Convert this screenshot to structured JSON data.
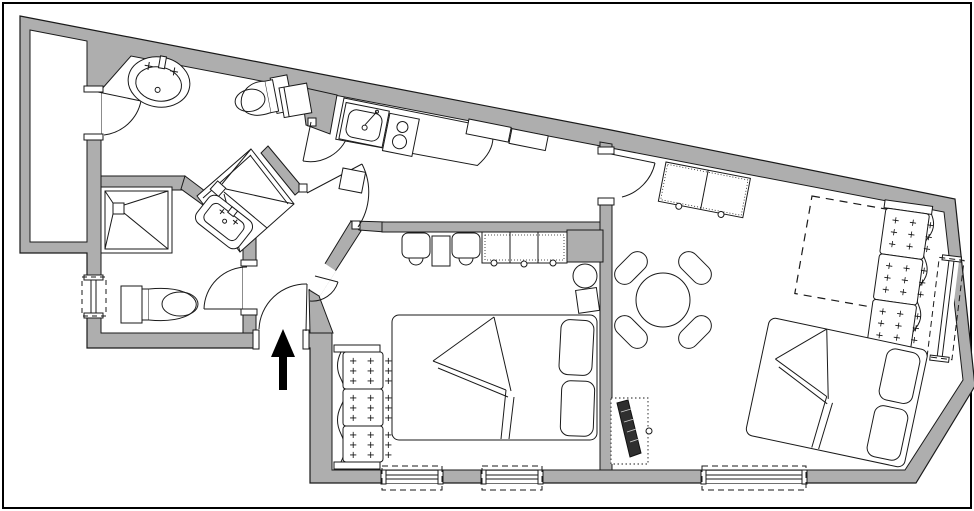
{
  "meta": {
    "title": "apartment-floor-plan",
    "drawing_type": "architectural floor plan"
  },
  "colors": {
    "background": "#ffffff",
    "wall_fill": "#aeaeae",
    "line": "#1a1a1a",
    "tv_fill": "#2f2f2f",
    "frame": "#000000",
    "arrow": "#000000"
  },
  "decor": {
    "plus_row": "+ + +"
  },
  "entrance": {
    "symbol": "entrance-arrow",
    "direction": "up-into-plan"
  },
  "lightwell": {
    "id": "lightwell"
  },
  "rooms": [
    {
      "id": "bathroom",
      "fixtures": [
        "oval-washbasin",
        "toilet",
        "corner-shower",
        "duct"
      ]
    },
    {
      "id": "shower-room",
      "fixtures": [
        "square-shower-tray",
        "small-washbasin",
        "toilet",
        "window-left"
      ]
    },
    {
      "id": "hall",
      "fixtures": [
        "entrance-door",
        "door-to-wc",
        "door-to-kitchen",
        "door-to-bedroom",
        "door-small"
      ]
    },
    {
      "id": "kitchen-dining",
      "fixtures": [
        "kitchen-sink",
        "stove-2-burner",
        "counter",
        "wall-cabinets",
        "cart"
      ]
    },
    {
      "id": "bedroom-middle",
      "fixtures": [
        "double-bed",
        "sofa-3-cushion",
        "wardrobe-dotted",
        "armchair",
        "armchair",
        "side-table",
        "round-side-table",
        "stool",
        "window",
        "window"
      ]
    },
    {
      "id": "living-room",
      "fixtures": [
        "round-dining-table",
        "chair",
        "chair",
        "chair",
        "chair",
        "wardrobe-dotted",
        "sofa-bed-dashed",
        "sofa-3-cushion",
        "double-bed",
        "tv-unit",
        "window-bottom",
        "window-right",
        "door"
      ]
    }
  ]
}
